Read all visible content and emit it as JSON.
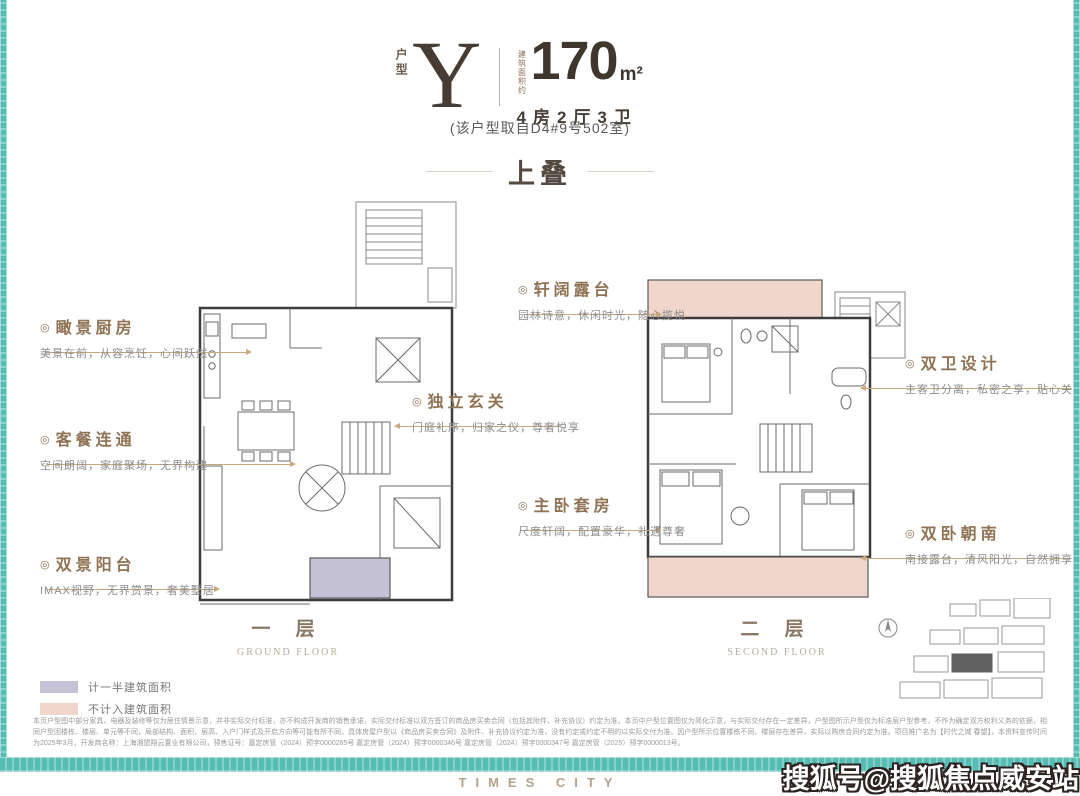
{
  "header": {
    "unit_type_label": "户型",
    "unit_letter": "Y",
    "area_label": "建筑面积约",
    "area_value": "170",
    "area_unit": "m²",
    "layout": "4房2厅3卫",
    "source_note": "(该户型取自D4#9号502室)"
  },
  "section_title": "上叠",
  "bullet": "◎",
  "callouts": {
    "kitchen": {
      "title": "瞰景厨房",
      "desc": "美景在前，从容烹饪，心间跃然"
    },
    "dining": {
      "title": "客餐连通",
      "desc": "空间朗阔，家庭聚场，无界构建"
    },
    "balcony": {
      "title": "双景阳台",
      "desc": "IMAX视野，无界赏景，奢美墅居"
    },
    "foyer": {
      "title": "独立玄关",
      "desc": "门庭礼序，归家之仪，尊奢悦享"
    },
    "terrace": {
      "title": "轩阔露台",
      "desc": "园林诗意，休闲时光，随心揽悦"
    },
    "baths": {
      "title": "双卫设计",
      "desc": "主客卫分离，私密之享，贴心关照"
    },
    "master": {
      "title": "主卧套房",
      "desc": "尺度轩阔，配置豪华，礼遇尊奢"
    },
    "south": {
      "title": "双卧朝南",
      "desc": "南接露台，清风阳光，自然拥享"
    }
  },
  "floors": [
    {
      "name": "一 层",
      "name_en": "GROUND FLOOR"
    },
    {
      "name": "二 层",
      "name_en": "SECOND FLOOR"
    }
  ],
  "legend": [
    {
      "label": "计一半建筑面积",
      "color": "#c6c2d6"
    },
    {
      "label": "不计入建筑面积",
      "color": "#f1d6cb"
    }
  ],
  "disclaimer": "本页户型图中部分家具、电器及装修等仅为居住情景示意，并非实际交付标准，亦不构成开发商的销售承诺，实际交付标准以双方签订的商品房买卖合同（包括其附件、补充协议）约定为准。本页中户型位置图仅为简化示意，与实际交付存在一定差异，户型图所示户型仅为标准层户型参考，不作为确定双方权利义务的依据，相同户型因楼栋、楼层、单元等不同，局部结构、面积、层高、入户门样式及开启方向等可能有所不同，具体房屋户型以《商品房买卖合同》及附件、补充协议约定为准，没有约定或约定不明的以实际交付为准。因户型所示位置楼栋不同、楼层存在差异，实际以购房合同约定为准。项目推广名为【时代之城 春望】，本资料宣传时间为2025年3月，开发商名称：上海湘盟翔云置业有限公司，预售证号：嘉定房管（2024）预字0000265号 嘉定房管（2024）预字0000346号 嘉定房管（2024）预字0000347号 嘉定房管（2025）预字0000013号。",
  "footer": {
    "brand": "TIMES CITY",
    "watermark": "搜狐号@搜狐焦点威安站"
  },
  "colors": {
    "teal_border": "#57bcb4",
    "accent_brown": "#8f7355",
    "dark_text": "#463c33",
    "connector_line": "#c9a87c",
    "terrace_pink": "#f1d6cb",
    "half_area_lavender": "#c6c2d6"
  }
}
